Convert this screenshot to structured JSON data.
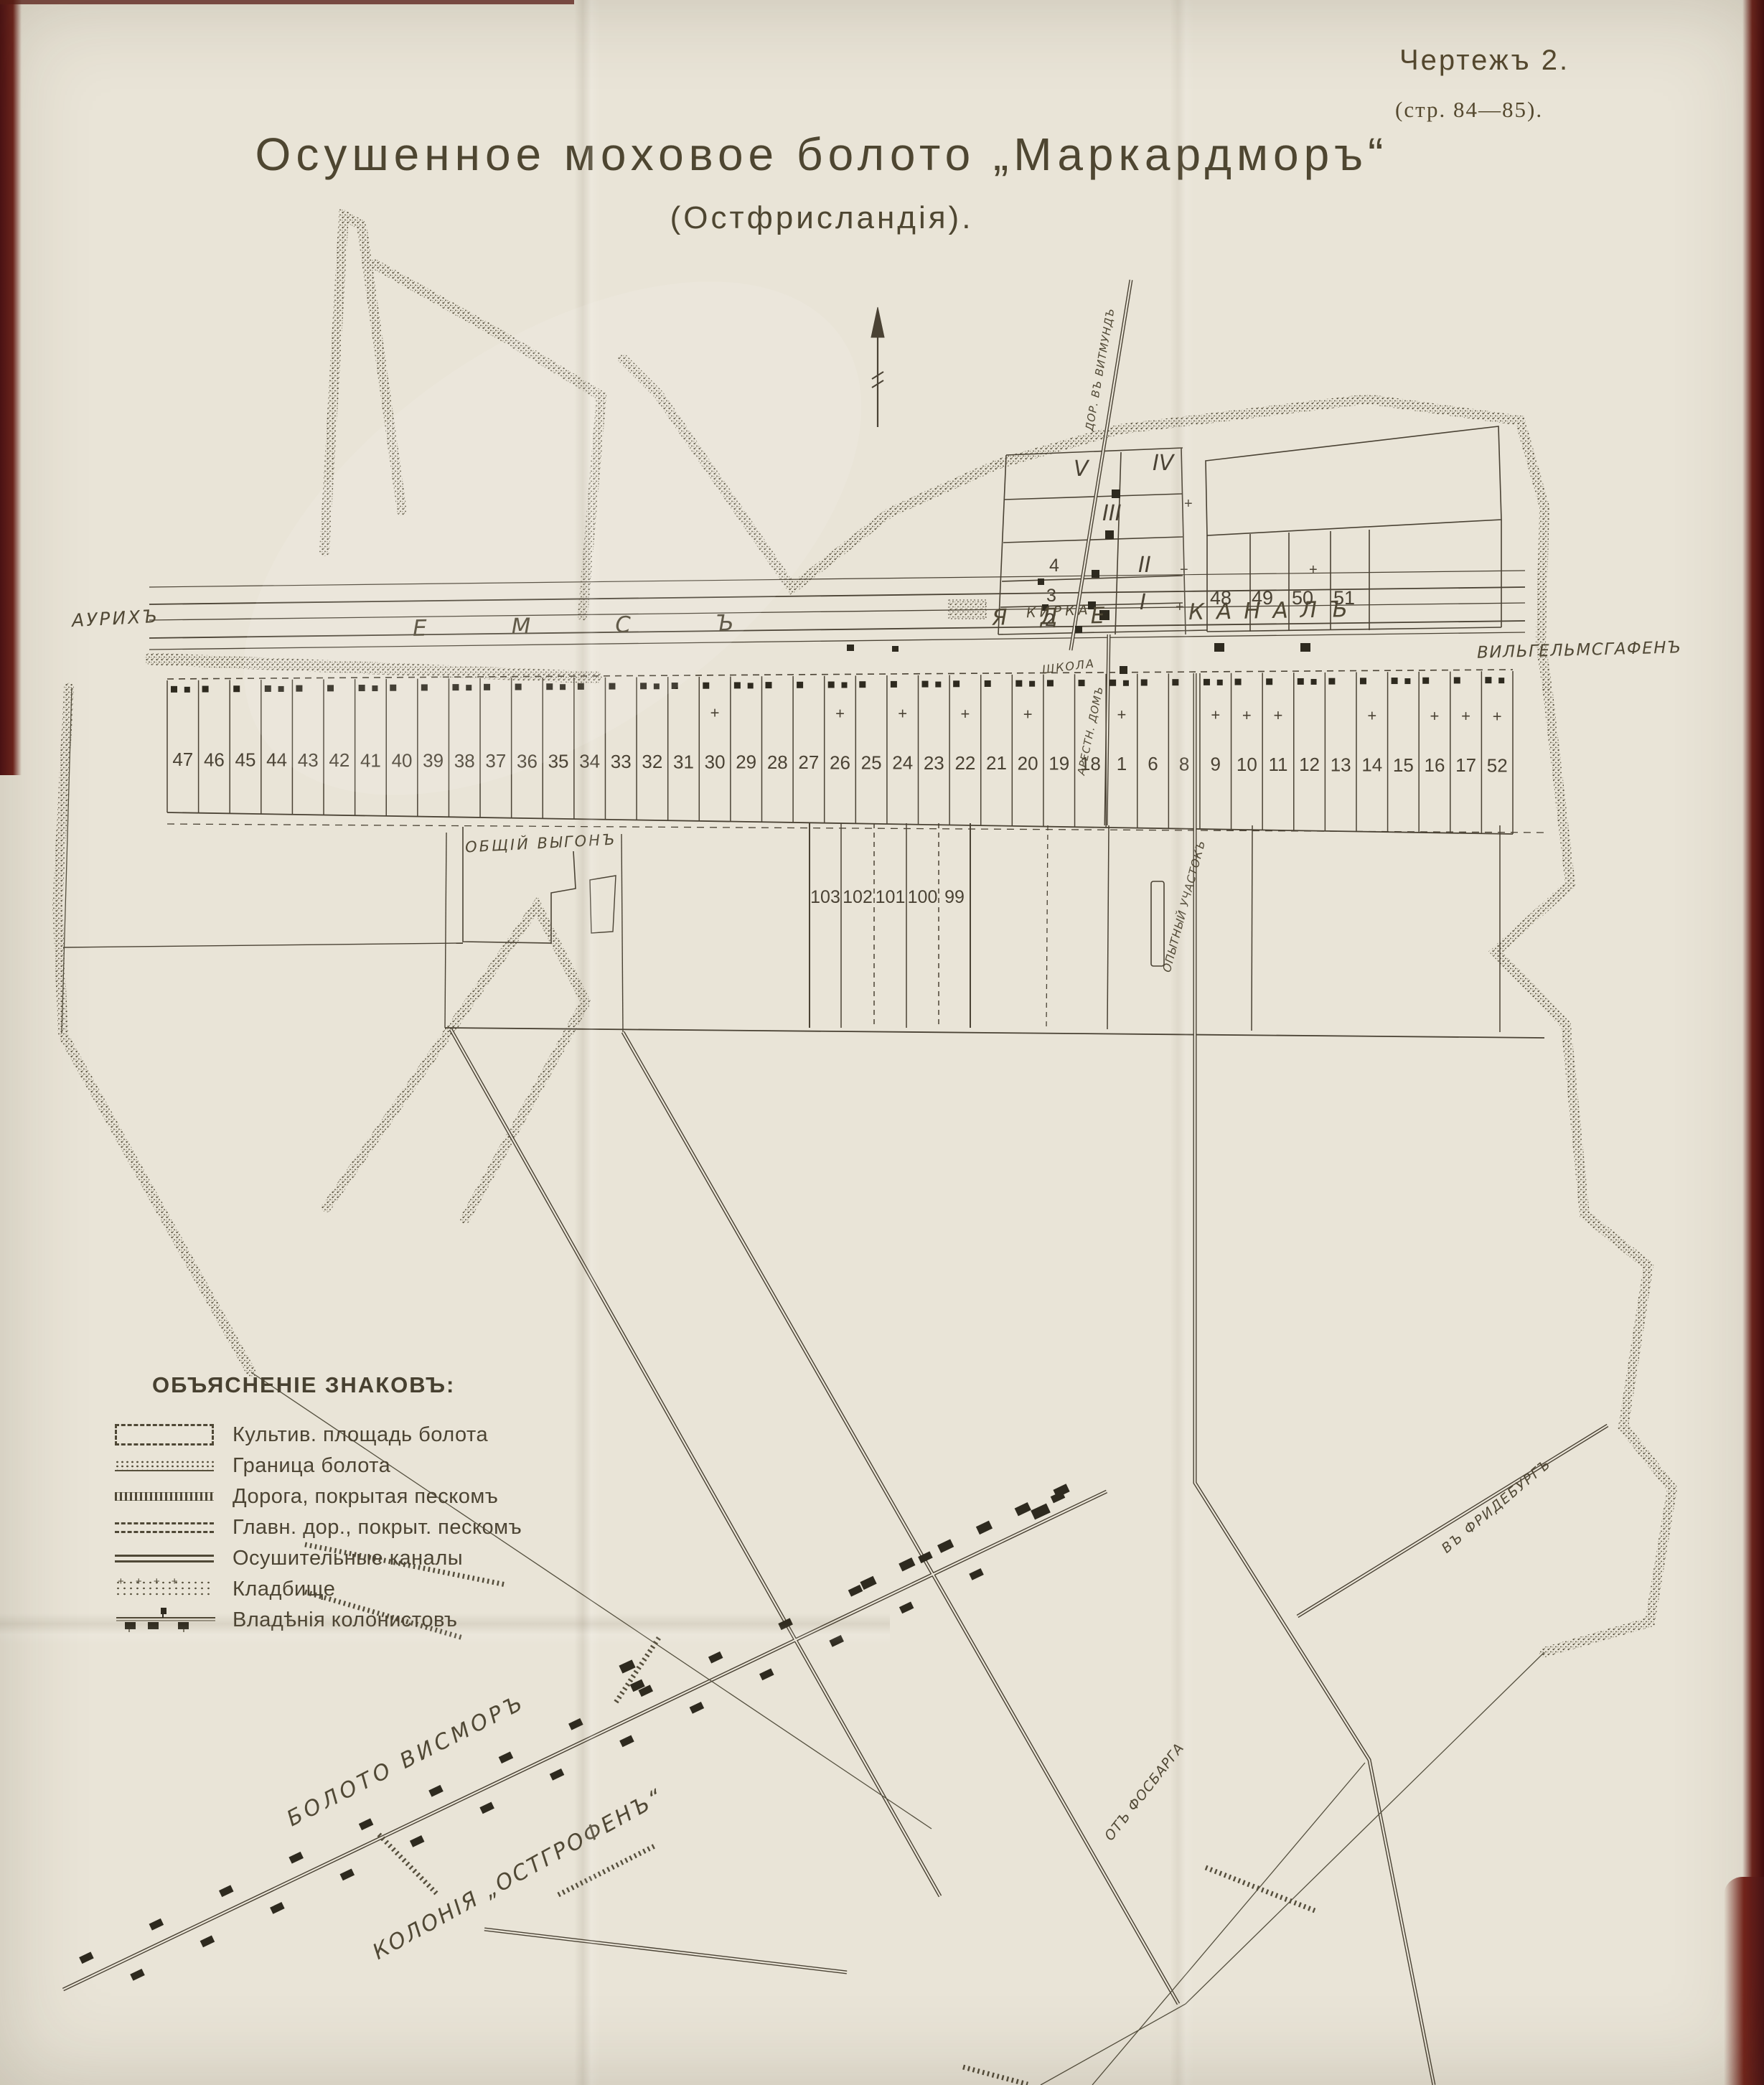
{
  "header": {
    "figure_label": "Чертежъ 2.",
    "pages_ref": "(стр. 84—85).",
    "title": "Осушенное моховое болото „Маркардморъ“",
    "subtitle": "(Остфрисландія)."
  },
  "legend": {
    "heading": "ОБЪЯСНЕНІЕ ЗНАКОВЪ:",
    "items": [
      {
        "symbol": "dashed-rectangle",
        "label": "Культив. площадь болота"
      },
      {
        "symbol": "stipple-band",
        "label": "Граница болота"
      },
      {
        "symbol": "hatched-road",
        "label": "Дорога, покрытая пескомъ"
      },
      {
        "symbol": "dashed-double-road",
        "label": "Главн. дор., покрыт. пескомъ"
      },
      {
        "symbol": "double-line",
        "label": "Осушительные каналы"
      },
      {
        "symbol": "cemetery",
        "label": "Кладбище"
      },
      {
        "symbol": "colonist-houses",
        "label": "Владѣнія колонистовъ"
      }
    ]
  },
  "map": {
    "canal_parts": [
      "ЕМСЪ",
      "ЯДЕ",
      "КАНАЛЪ"
    ],
    "labels": {
      "aurich": "АУРИХЪ",
      "wilhelmshafen": "ВИЛЬГЕЛЬМСГАФЕНЪ",
      "kirka": "КИРКА",
      "school": "ШКОЛА",
      "arrest_house": "АРЕСТН. ДОМЪ",
      "common_pasture": "ОБЩІЙ ВЫГОНЪ",
      "experimental_plot": "ОПЫТНЫЙ УЧАСТОКЪ",
      "road_to_wittmund": "ДОР. ВЪ ВИТМУНДЪ",
      "to_friedeburg": "ВЪ ФРИДЕБУРГЪ",
      "from_fosbarga": "ОТЪ ФОСБАРГА",
      "wismor_bog": "БОЛОТО ВИСМОРЪ",
      "colony_ostgrofen": "КОЛОНІЯ „ОСТГРОФЕНЪ“"
    },
    "main_strip": [
      "47",
      "46",
      "45",
      "44",
      "43",
      "42",
      "41",
      "40",
      "39",
      "38",
      "37",
      "36",
      "35",
      "34",
      "33",
      "32",
      "31",
      "30",
      "29",
      "28",
      "27",
      "26",
      "25",
      "24",
      "23",
      "22",
      "21",
      "20",
      "19",
      "18",
      "1",
      "6",
      "8",
      "9",
      "10",
      "11",
      "12",
      "13",
      "14",
      "15",
      "16",
      "17",
      "52"
    ],
    "crossed_plots": [
      "30",
      "26",
      "24",
      "22",
      "20",
      "1",
      "9",
      "10",
      "11",
      "14",
      "16",
      "17",
      "52"
    ],
    "second_strip": [
      "103",
      "102",
      "101",
      "100",
      "99"
    ],
    "north_roman": [
      "V",
      "IV",
      "III",
      "II",
      "I"
    ],
    "north_arabic": [
      "4",
      "3",
      "2"
    ],
    "north_right": [
      "48",
      "49",
      "50",
      "51"
    ]
  },
  "colors": {
    "paper": "#e9e4d7",
    "ink": "#4a4234",
    "house_black": "#2e2a1f",
    "book_edge": "#5a1a16"
  }
}
